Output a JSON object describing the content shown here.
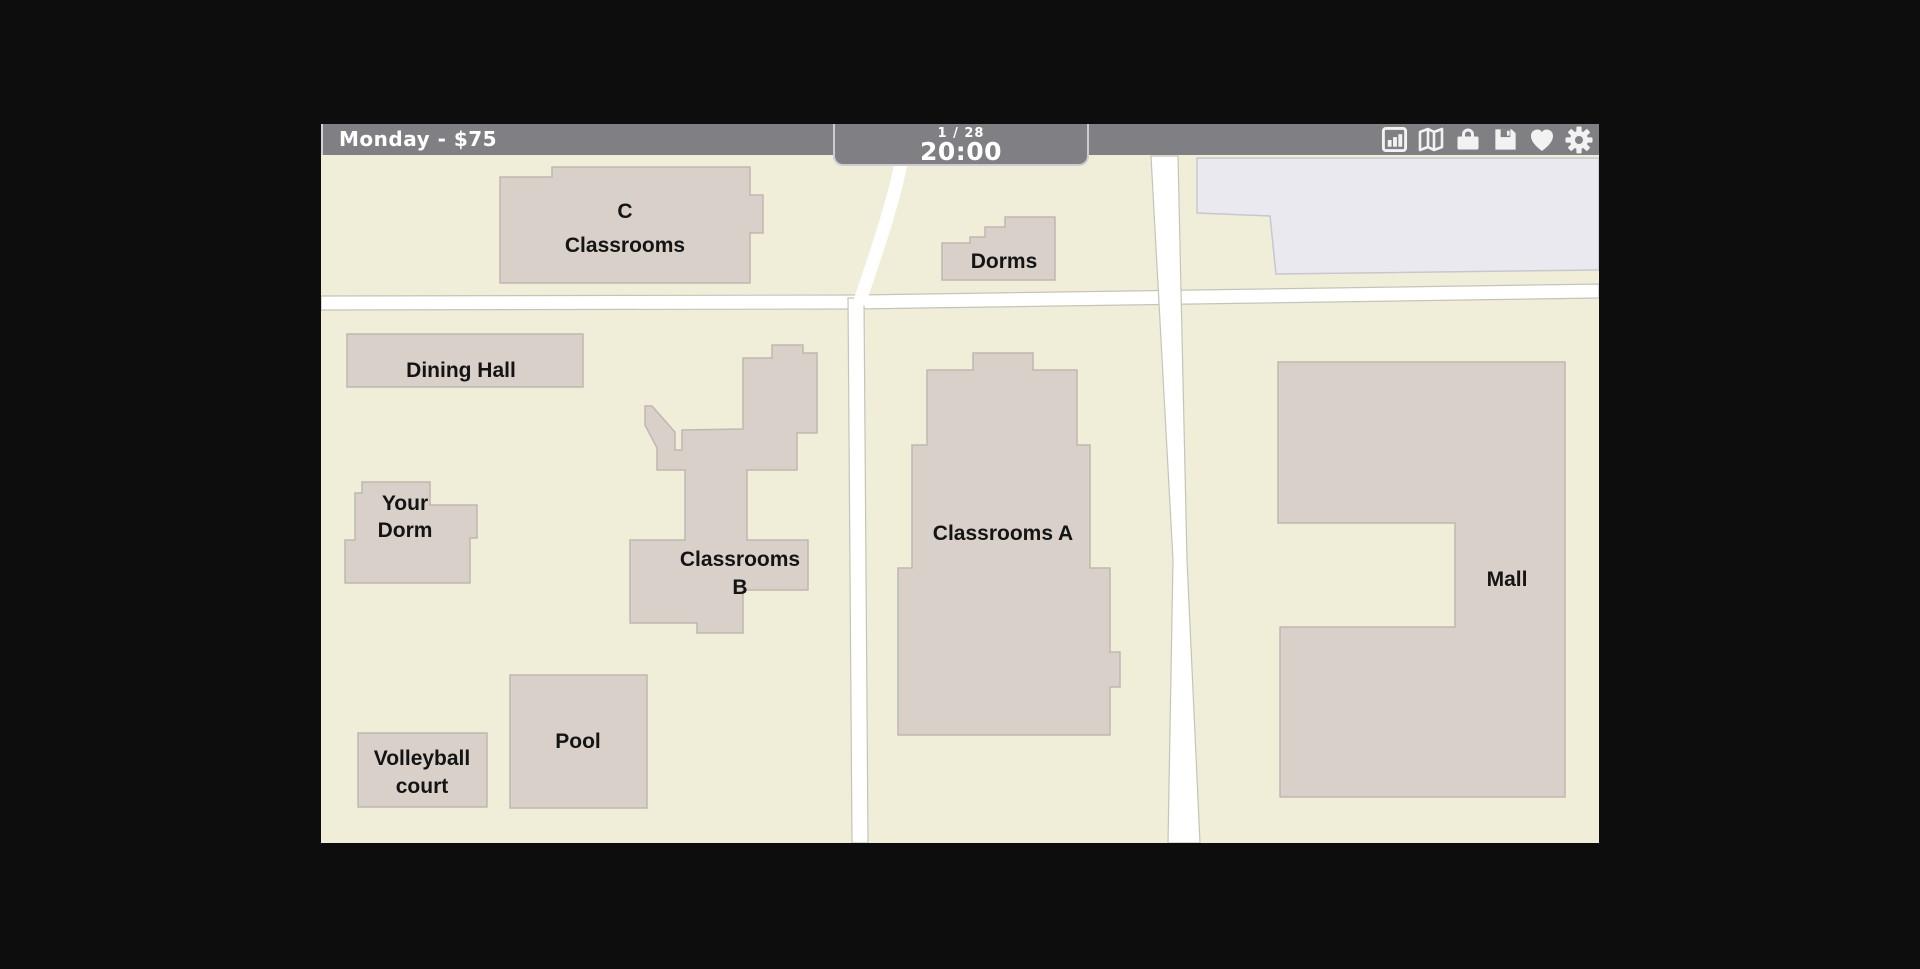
{
  "scene": {
    "background": "#0d0d0d"
  },
  "topbar": {
    "left_label": "Monday - $75",
    "day_counter": "1 / 28",
    "time": "20:00",
    "colors": {
      "bar": "#807f84",
      "text": "#ffffff",
      "box_border": "#cdccd1"
    },
    "icons": [
      {
        "name": "stats-icon"
      },
      {
        "name": "map-icon"
      },
      {
        "name": "inventory-icon"
      },
      {
        "name": "save-icon"
      },
      {
        "name": "relationships-icon"
      },
      {
        "name": "settings-icon"
      }
    ]
  },
  "map": {
    "colors": {
      "ground": "#f0eed9",
      "road": "#ffffff",
      "road_border": "#c6c4b8",
      "building": "#d8d0c9",
      "building_border": "#c0b8b0",
      "plaza": "#eae9f0",
      "plaza_border": "#c8c7ce",
      "label": "#141414"
    },
    "plaza": {
      "name": "plaza-area",
      "path": "M876,32 L1278,32 L1278,144 L955,148 L949,90 L876,87 Z"
    },
    "roads": [
      {
        "name": "main-horizontal-road",
        "path": "M0,170 L536,169 L1278,158 L1278,172 L536,183 L0,184 Z"
      },
      {
        "name": "center-vertical-road",
        "path": "M527,172 L543,172 L547,717 L531,717 Z"
      },
      {
        "name": "east-vertical-road",
        "path": "M830,30 L857,30 L866,434 L879,717 L847,717 L852,434 Z"
      },
      {
        "name": "north-curve-road",
        "path": "M581,32 C573,76 554,130 538,178",
        "stroke": 13
      }
    ],
    "buildings": [
      {
        "id": "c-classrooms",
        "label_lines": [
          "C",
          "Classrooms"
        ],
        "label_x": 304,
        "label_y": 92,
        "line_h": 34,
        "points": "179,51 231,51 231,41 429,41 429,69 442,69 442,107 429,107 429,157 179,157"
      },
      {
        "id": "dorms",
        "label_lines": [
          "Dorms"
        ],
        "label_x": 683,
        "label_y": 142,
        "line_h": 29,
        "points": "621,117 649,117 649,111 664,111 664,101 684,101 684,91 734,91 734,154 621,154"
      },
      {
        "id": "dining-hall",
        "label_lines": [
          "Dining Hall"
        ],
        "label_x": 140,
        "label_y": 251,
        "line_h": 29,
        "points": "26,208 262,208 262,261 26,261"
      },
      {
        "id": "your-dorm",
        "label_lines": [
          "Your",
          "Dorm"
        ],
        "label_x": 84,
        "label_y": 384,
        "line_h": 27,
        "points": "41,356 109,356 109,379 156,379 156,412 149,412 149,457 24,457 24,414 34,414 34,367 41,367"
      },
      {
        "id": "classrooms-b",
        "label_lines": [
          "Classrooms",
          "B"
        ],
        "label_x": 419,
        "label_y": 440,
        "line_h": 28,
        "points": "451,219 482,219 482,227 496,227 496,307 476,307 476,344 426,344 426,414 487,414 487,464 422,464 422,507 376,507 376,497 309,497 309,414 364,414 364,344 336,344 336,322 324,299 324,280 331,280 354,306 354,324 361,324 361,304 422,303 422,232 451,232"
      },
      {
        "id": "classrooms-a",
        "label_lines": [
          "Classrooms A"
        ],
        "label_x": 682,
        "label_y": 414,
        "line_h": 29,
        "points": "652,227 712,227 712,244 756,244 756,319 769,319 769,442 789,442 789,526 799,526 799,561 789,561 789,609 577,609 577,442 591,442 591,319 606,319 606,244 652,244"
      },
      {
        "id": "mall",
        "label_lines": [
          "Mall"
        ],
        "label_x": 1186,
        "label_y": 460,
        "line_h": 29,
        "points": "957,236 1244,236 1244,671 959,671 959,501 1134,501 1134,397 957,397"
      },
      {
        "id": "pool",
        "label_lines": [
          "Pool"
        ],
        "label_x": 257,
        "label_y": 622,
        "line_h": 29,
        "points": "189,549 326,549 326,682 189,682"
      },
      {
        "id": "volleyball-court",
        "label_lines": [
          "Volleyball",
          "court"
        ],
        "label_x": 101,
        "label_y": 639,
        "line_h": 28,
        "points": "37,607 166,607 166,681 37,681"
      }
    ]
  }
}
